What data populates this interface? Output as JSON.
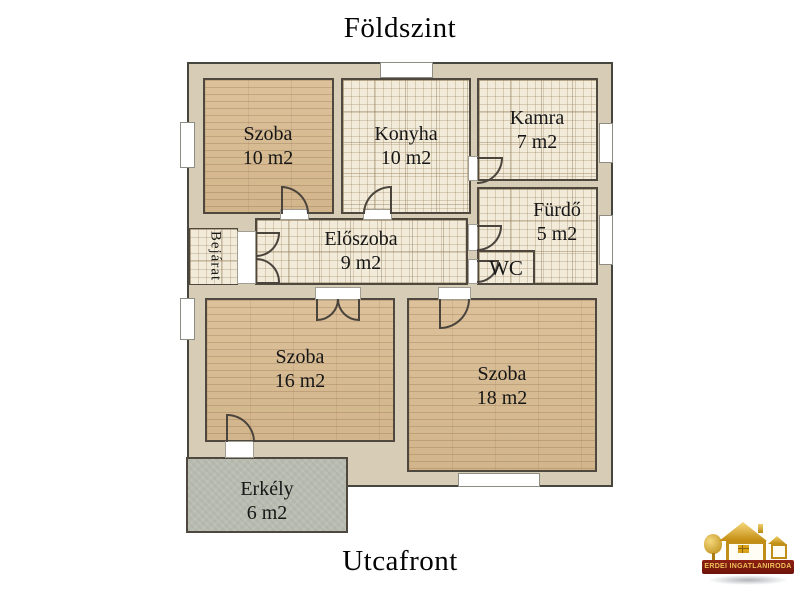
{
  "titles": {
    "top": "Földszint",
    "bottom": "Utcafront"
  },
  "rooms": [
    {
      "name": "Szoba",
      "area": "10 m2"
    },
    {
      "name": "Konyha",
      "area": "10 m2"
    },
    {
      "name": "Kamra",
      "area": "7 m2"
    },
    {
      "name": "Fürdő",
      "area": "5 m2"
    },
    {
      "name": "WC"
    },
    {
      "name": "Előszoba",
      "area": "9 m2"
    },
    {
      "name": "Bejárat"
    },
    {
      "name": "Szoba",
      "area": "16 m2"
    },
    {
      "name": "Szoba",
      "area": "18 m2"
    },
    {
      "name": "Erkély",
      "area": "6 m2"
    }
  ],
  "logo": {
    "text": "ERDEI INGATLANIRODA"
  },
  "colors": {
    "wall": "#d7ccb5",
    "outline": "#47463e",
    "wood": "#d8bd97",
    "tile": "#f2ebda",
    "balcony": "#b9bcb1",
    "banner": "#7a1b0e",
    "gold": "#d9a21b"
  }
}
